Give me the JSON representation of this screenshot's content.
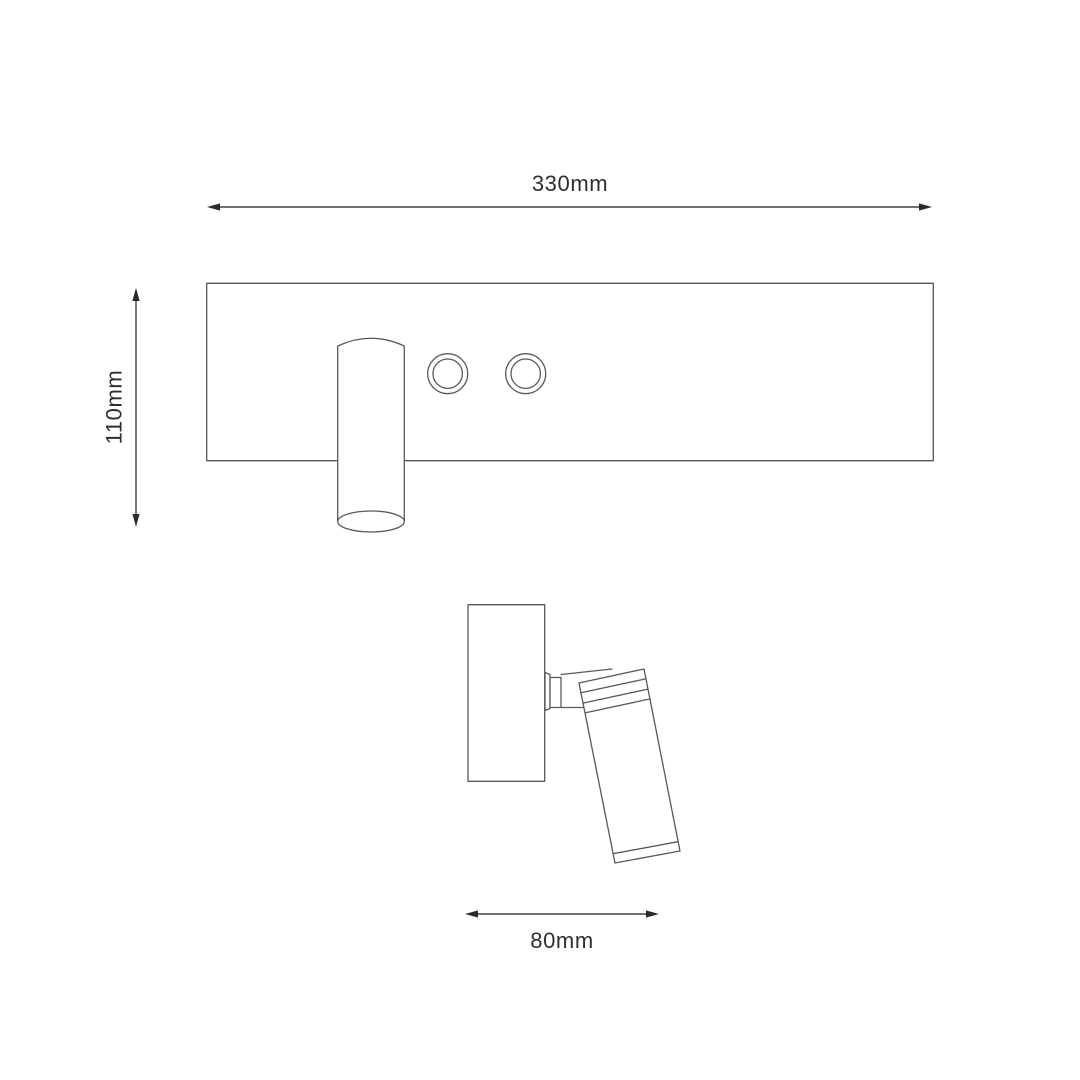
{
  "colors": {
    "background": "#ffffff",
    "drawing_line": "#58595b",
    "dimension_line": "#3f4042",
    "arrowhead": "#2b2b2b",
    "text": "#2e2e30"
  },
  "dimensions": {
    "width": {
      "label": "330mm"
    },
    "height": {
      "label": "110mm"
    },
    "depth": {
      "label": "80mm"
    }
  }
}
